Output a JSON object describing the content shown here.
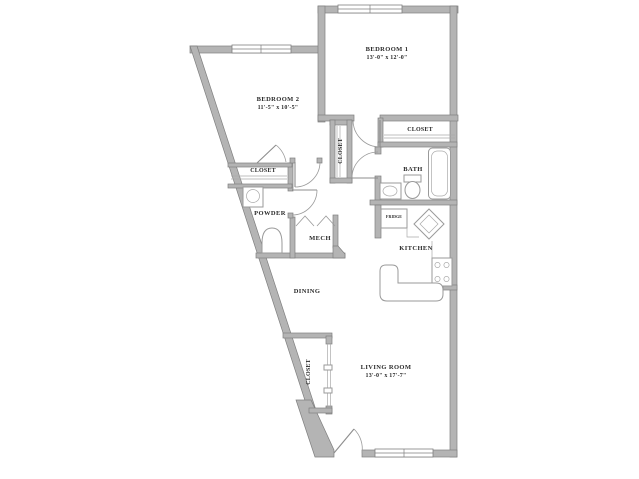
{
  "floor_plan": {
    "rooms": {
      "bedroom1": {
        "name": "BEDROOM 1",
        "dims": "13'-0\" x 12'-0\""
      },
      "bedroom2": {
        "name": "BEDROOM 2",
        "dims": "11'-5\" x 10'-5\""
      },
      "living_room": {
        "name": "LIVING ROOM",
        "dims": "13'-0\" x 17'-7\""
      },
      "dining": {
        "name": "DINING"
      },
      "kitchen": {
        "name": "KITCHEN"
      },
      "bath": {
        "name": "BATH"
      },
      "powder": {
        "name": "POWDER"
      },
      "mech": {
        "name": "MECH"
      },
      "closet_top_right": {
        "name": "CLOSET"
      },
      "closet_bedroom2": {
        "name": "CLOSET"
      },
      "closet_hall": {
        "name": "CLOSET"
      },
      "closet_entry": {
        "name": "CLOSET"
      },
      "fridge": {
        "name": "FRIDGE"
      }
    },
    "colors": {
      "bg": "#ffffff",
      "wall_fill": "#b4b4b4",
      "wall_edge": "#7f7f7f",
      "line": "#9a9a9a",
      "text": "#2b2b2b"
    }
  }
}
